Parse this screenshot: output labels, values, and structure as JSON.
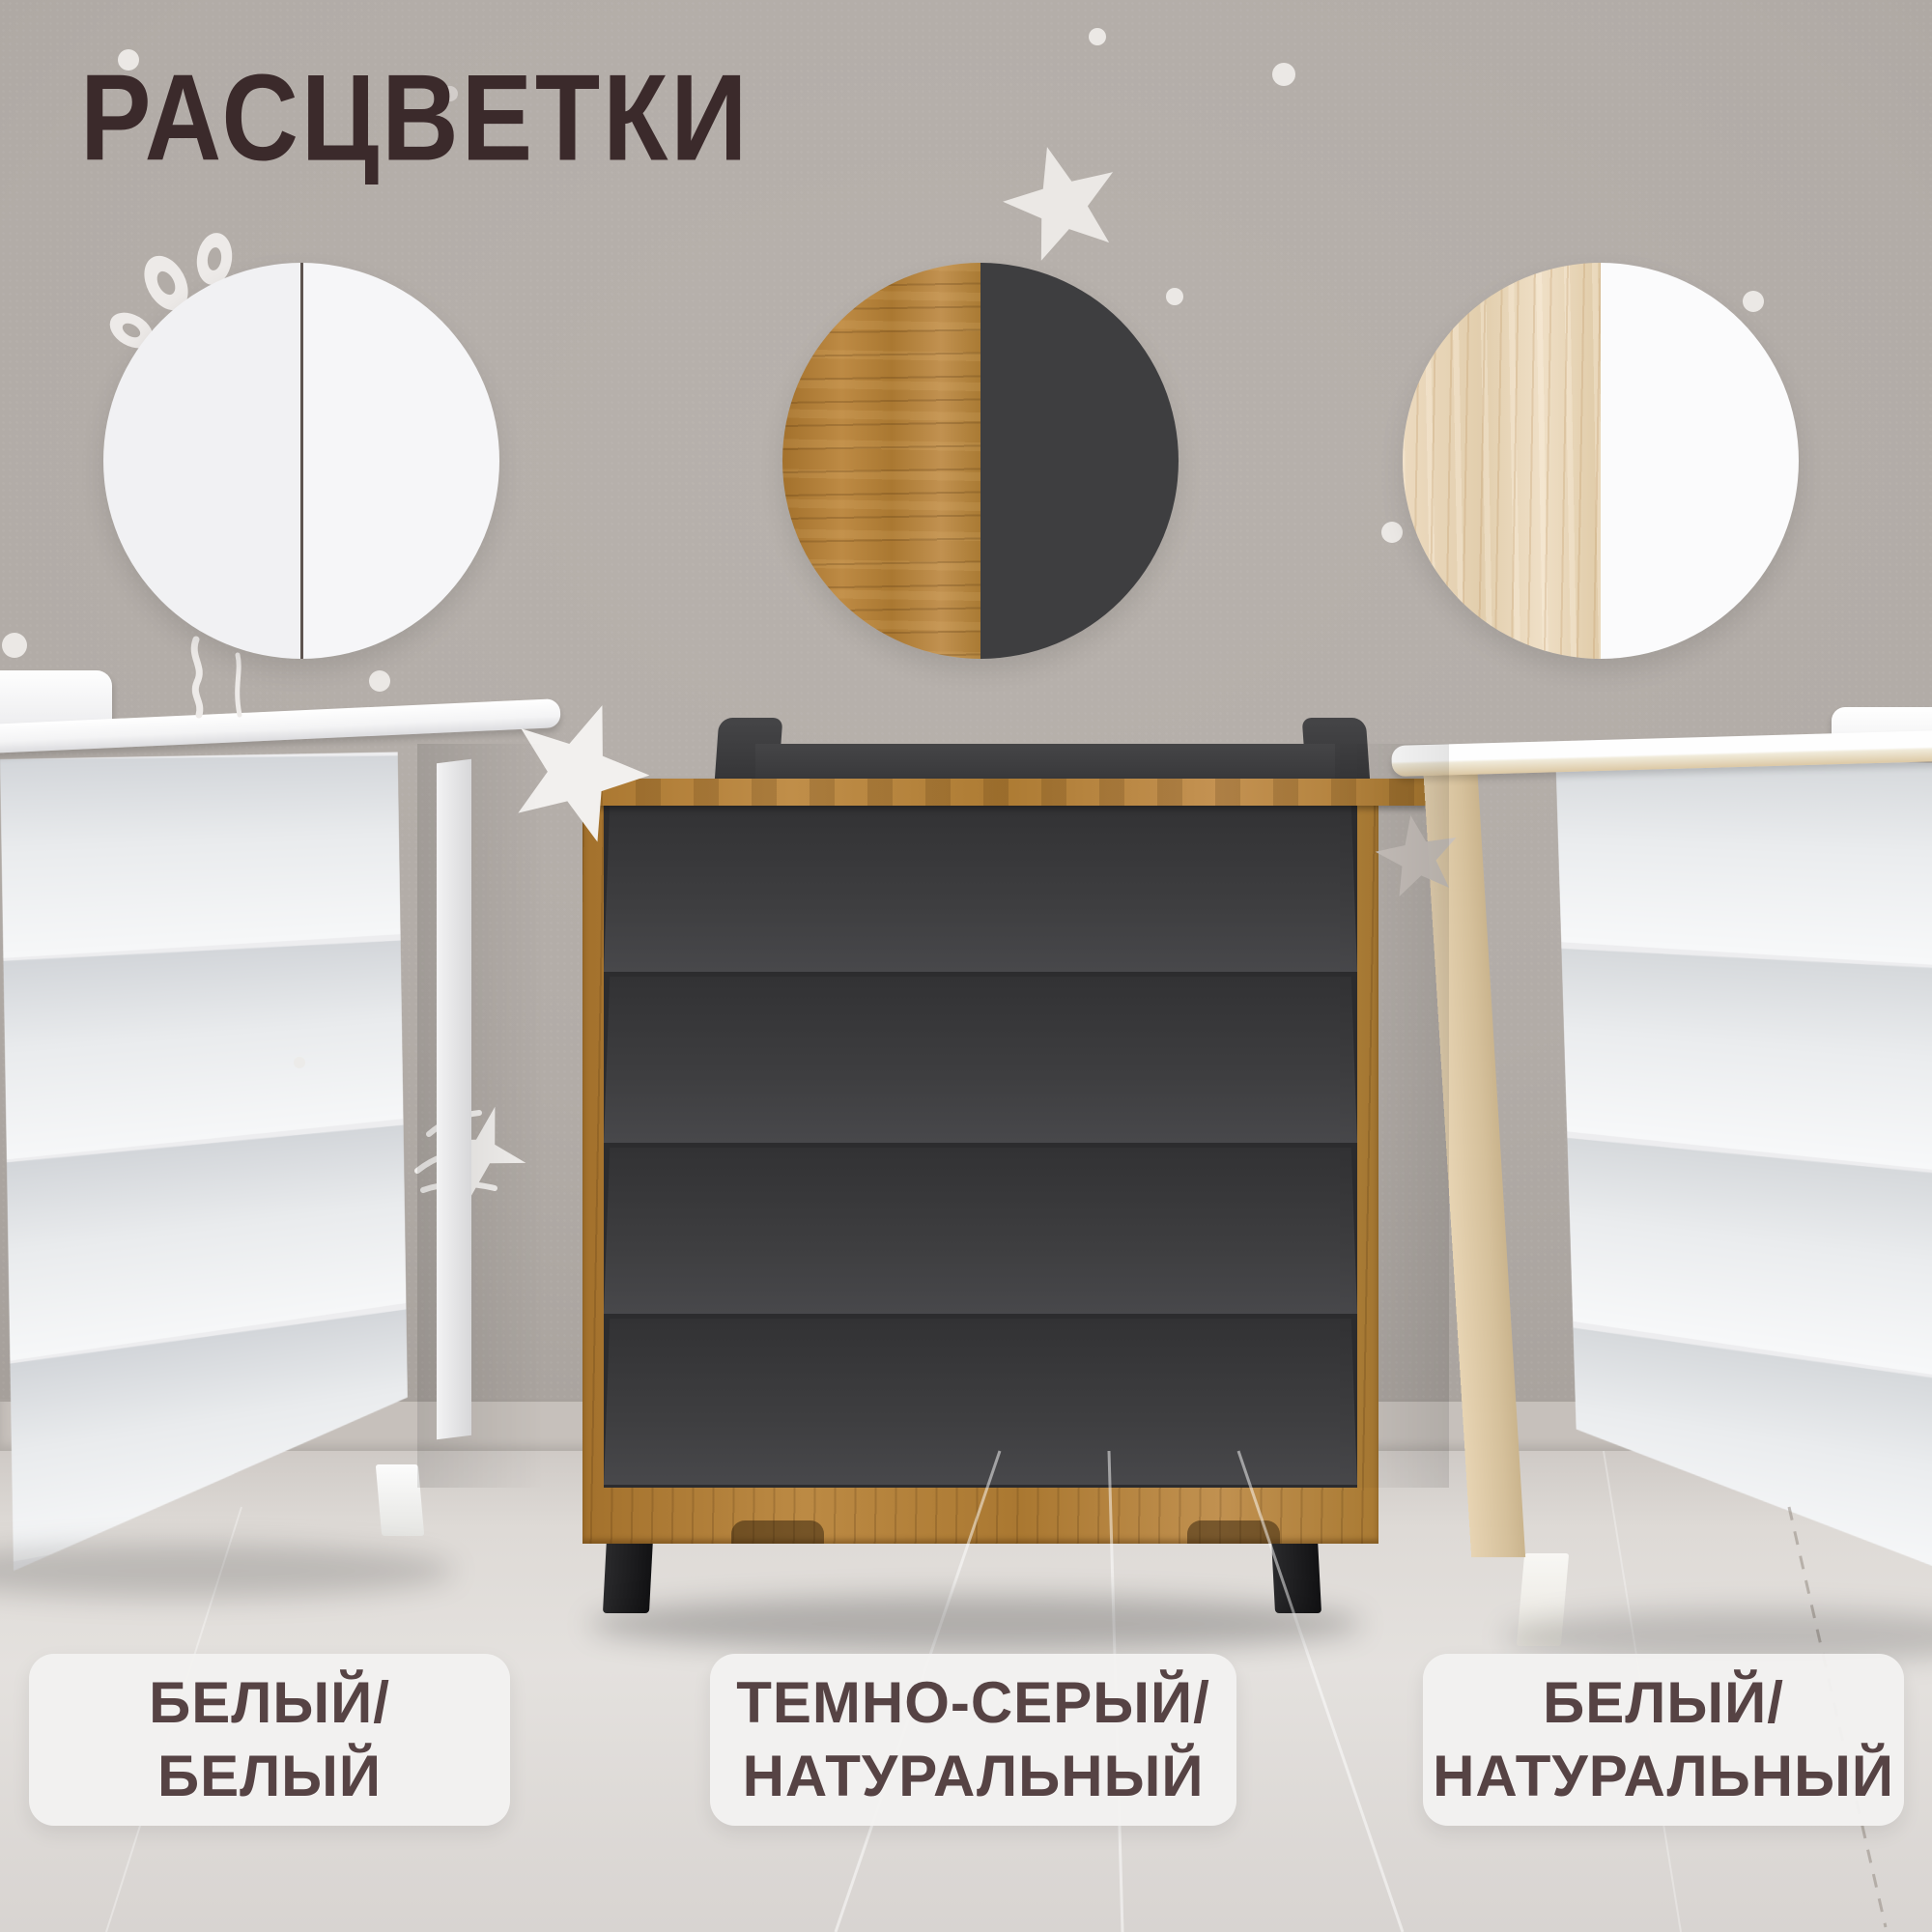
{
  "page": {
    "type": "product-color-options-card",
    "title": "РАСЦВЕТКИ"
  },
  "options": [
    {
      "name": "БЕЛЫЙ/БЕЛЫЙ",
      "label_line1": "БЕЛЫЙ/",
      "label_line2": "БЕЛЫЙ",
      "swatch_left": "white",
      "swatch_right": "white"
    },
    {
      "name": "ТЕМНО-СЕРЫЙ/НАТУРАЛЬНЫЙ",
      "label_line1": "ТЕМНО-СЕРЫЙ/",
      "label_line2": "НАТУРАЛЬНЫЙ",
      "swatch_left": "oak-wood",
      "swatch_right": "dark-gray"
    },
    {
      "name": "БЕЛЫЙ/НАТУРАЛЬНЫЙ",
      "label_line1": "БЕЛЫЙ/",
      "label_line2": "НАТУРАЛЬНЫЙ",
      "swatch_left": "pine-wood",
      "swatch_right": "white"
    }
  ],
  "colors": {
    "wall": "#b2aca7",
    "floor": "#ddd9d6",
    "title_text": "#3b2a2b",
    "label_text": "#564344",
    "label_background": "#f3f1f0",
    "dark_gray_furniture": "#3b3b3d",
    "oak_wood": "#b07c35",
    "pine_wood": "#e8d6ba",
    "white_furniture": "#f3f3f4",
    "leg_black": "#1c1c1e"
  }
}
